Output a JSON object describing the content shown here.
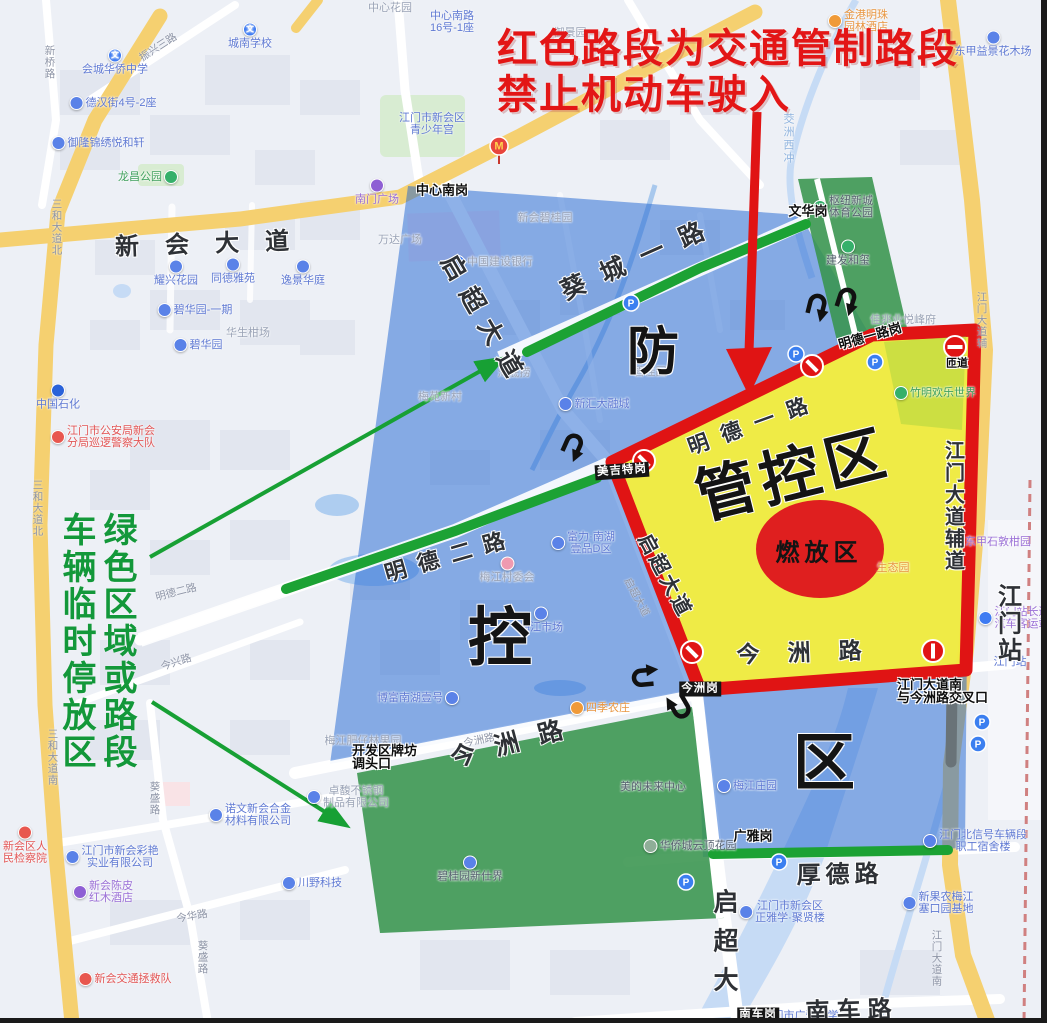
{
  "annotations": {
    "red_notice_line1": "红色路段为交通管制路段",
    "red_notice_line2": "禁止机动车驶入",
    "green_note_phrase1": "绿色区域或路段",
    "green_note_phrase2": "车辆临时停放区"
  },
  "zones": {
    "blue_zone_name": "防控区",
    "blue_zone_chars": [
      {
        "c": "防",
        "x": 653,
        "y": 347,
        "size": 52
      },
      {
        "c": "控",
        "x": 500,
        "y": 633,
        "size": 64
      },
      {
        "c": "区",
        "x": 824,
        "y": 757,
        "size": 62
      }
    ],
    "yellow_zone_label": {
      "t": "管控区",
      "x": 792,
      "y": 470,
      "size": 60,
      "sp": 6,
      "rot": -14
    },
    "firework_label": {
      "t": "燃放区",
      "x": 819,
      "y": 550,
      "size": 24,
      "sp": 5
    }
  },
  "road_names_big": [
    {
      "t": "新会大道",
      "x": 215,
      "y": 241,
      "size": 24,
      "sp": 26,
      "rot": -2
    },
    {
      "t": "启超大道",
      "x": 486,
      "y": 320,
      "size": 25,
      "sp": 12,
      "rot": 60
    },
    {
      "t": "葵城一路",
      "x": 640,
      "y": 256,
      "size": 25,
      "sp": 18,
      "rot": -24
    },
    {
      "t": "明德一路",
      "x": 754,
      "y": 423,
      "size": 21,
      "sp": 14,
      "rot": -20
    },
    {
      "t": "明德二路",
      "x": 450,
      "y": 554,
      "size": 22,
      "sp": 12,
      "rot": -16
    },
    {
      "t": "今洲路",
      "x": 516,
      "y": 740,
      "size": 25,
      "sp": 20,
      "rot": -15
    },
    {
      "t": "今洲路",
      "x": 813,
      "y": 650,
      "size": 23,
      "sp": 28,
      "rot": -2
    },
    {
      "t": "启超大道",
      "x": 667,
      "y": 575,
      "size": 20,
      "sp": 3,
      "rot": 62
    },
    {
      "t": "厚德路",
      "x": 840,
      "y": 872,
      "size": 24,
      "sp": 5,
      "rot": -1
    },
    {
      "t": "南车路",
      "x": 852,
      "y": 1008,
      "size": 24,
      "sp": 7,
      "rot": -2
    },
    {
      "t": "启超大",
      "x": 723,
      "y": 947,
      "size": 25,
      "sp": 14,
      "vert": true
    },
    {
      "t": "江门大道辅道",
      "x": 953,
      "y": 506,
      "size": 20,
      "sp": 2,
      "vert": true
    },
    {
      "t": "江门站",
      "x": 1007,
      "y": 624,
      "size": 24,
      "sp": 3,
      "vert": true
    }
  ],
  "checkpoints": [
    {
      "t": [
        "中心南岗"
      ],
      "x": 442,
      "y": 190
    },
    {
      "t": [
        "文华岗"
      ],
      "x": 808,
      "y": 211
    },
    {
      "t": [
        "明德一路岗"
      ],
      "x": 870,
      "y": 336,
      "rot": -16
    },
    {
      "t": [
        "美吉特岗"
      ],
      "x": 622,
      "y": 471,
      "s": "inv",
      "rot": -4
    },
    {
      "t": [
        "今洲岗"
      ],
      "x": 700,
      "y": 689,
      "s": "inv"
    },
    {
      "t": [
        "南车岗"
      ],
      "x": 758,
      "y": 1015,
      "s": "inv"
    },
    {
      "t": [
        "开发区牌坊",
        "调头口"
      ],
      "x": 352,
      "y": 744,
      "anchor": "l"
    },
    {
      "t": [
        "广雅岗"
      ],
      "x": 753,
      "y": 836
    },
    {
      "t": [
        "江门大道南",
        "与今洲路交叉口"
      ],
      "x": 897,
      "y": 678,
      "anchor": "l"
    },
    {
      "t": [
        "匝道"
      ],
      "x": 957,
      "y": 364,
      "size": 11
    }
  ],
  "pois": [
    {
      "t": [
        "会城华侨中学"
      ],
      "x": 115,
      "y": 62,
      "s": "b",
      "ic": "#3e7bf2",
      "g": "文",
      "ip": "t"
    },
    {
      "t": [
        "城南学校"
      ],
      "x": 250,
      "y": 36,
      "s": "b",
      "ic": "#3e7bf2",
      "g": "文",
      "ip": "t"
    },
    {
      "t": [
        "德汉街4号-2座"
      ],
      "x": 113,
      "y": 103,
      "s": "b",
      "ic": "#5a82e8",
      "ip": "l"
    },
    {
      "t": [
        "御隆锦绣悦和轩"
      ],
      "x": 98,
      "y": 143,
      "s": "b",
      "ic": "#5a82e8",
      "ip": "l"
    },
    {
      "t": [
        "龙昌公园"
      ],
      "x": 148,
      "y": 177,
      "s": "g",
      "ic": "#35b06a",
      "ip": "r"
    },
    {
      "t": [
        "中心花园"
      ],
      "x": 390,
      "y": 8,
      "s": "f"
    },
    {
      "t": [
        "中心南路",
        "16号-1座"
      ],
      "x": 452,
      "y": 22,
      "s": "b"
    },
    {
      "t": [
        "江门市新会区",
        "青少年宫"
      ],
      "x": 432,
      "y": 124,
      "s": "b"
    },
    {
      "t": [
        "南门广场"
      ],
      "x": 377,
      "y": 192,
      "s": "p",
      "ic": "#8e5fd4",
      "ip": "t"
    },
    {
      "t": [
        "万达广场"
      ],
      "x": 400,
      "y": 240,
      "s": "f"
    },
    {
      "t": [
        "御景园"
      ],
      "x": 570,
      "y": 33,
      "s": "f"
    },
    {
      "t": [
        "金港明珠",
        "园林酒店"
      ],
      "x": 858,
      "y": 21,
      "s": "o",
      "ic": "#f09a38",
      "ip": "l"
    },
    {
      "t": [
        "东甲益景花木场"
      ],
      "x": 993,
      "y": 44,
      "s": "b",
      "ic": "#5a82e8",
      "ip": "t"
    },
    {
      "t": [
        "碧桂园"
      ],
      "x": 650,
      "y": 372,
      "s": "f"
    },
    {
      "t": [
        "新会碧桂园"
      ],
      "x": 545,
      "y": 218,
      "s": "f"
    },
    {
      "t": [
        "中国建设银行"
      ],
      "x": 492,
      "y": 262,
      "s": "f",
      "ic": "#3e7bf2",
      "ip": "l"
    },
    {
      "t": [
        "耀兴花园"
      ],
      "x": 176,
      "y": 273,
      "s": "b",
      "ic": "#5a82e8",
      "ip": "t"
    },
    {
      "t": [
        "同德雅苑"
      ],
      "x": 233,
      "y": 271,
      "s": "b",
      "ic": "#5a82e8",
      "ip": "t"
    },
    {
      "t": [
        "逸景华庭"
      ],
      "x": 303,
      "y": 273,
      "s": "b",
      "ic": "#5a82e8",
      "ip": "t"
    },
    {
      "t": [
        "碧华园-一期"
      ],
      "x": 195,
      "y": 310,
      "s": "b",
      "ic": "#5a82e8",
      "ip": "l"
    },
    {
      "t": [
        "碧华园"
      ],
      "x": 198,
      "y": 345,
      "s": "b",
      "ic": "#5a82e8",
      "ip": "l"
    },
    {
      "t": [
        "华生柑场"
      ],
      "x": 248,
      "y": 333,
      "s": "f"
    },
    {
      "t": [
        "中国石化"
      ],
      "x": 58,
      "y": 397,
      "s": "b",
      "ic": "#2a62d9",
      "ip": "t"
    },
    {
      "t": [
        "江门市公安局新会",
        "分局巡逻警察大队"
      ],
      "x": 103,
      "y": 437,
      "s": "r",
      "ic": "#e8574f",
      "ip": "l"
    },
    {
      "t": [
        "海底捞"
      ],
      "x": 514,
      "y": 373,
      "s": "f"
    },
    {
      "t": [
        "新汇大融城"
      ],
      "x": 594,
      "y": 404,
      "s": "b",
      "ic": "#5a82e8",
      "ip": "l"
    },
    {
      "t": [
        "梅苑新村"
      ],
      "x": 440,
      "y": 397,
      "s": "f"
    },
    {
      "t": [
        "富力·南湖",
        "壹品D区"
      ],
      "x": 583,
      "y": 543,
      "s": "b",
      "ic": "#5a82e8",
      "ip": "l"
    },
    {
      "t": [
        "梅江村委会"
      ],
      "x": 507,
      "y": 570,
      "s": "f",
      "ic": "#ef9ab0",
      "ip": "t"
    },
    {
      "t": [
        "梅江市场"
      ],
      "x": 541,
      "y": 620,
      "s": "b",
      "ic": "#5a82e8",
      "ip": "t"
    },
    {
      "t": [
        "博富南湖壹号"
      ],
      "x": 418,
      "y": 698,
      "s": "b",
      "ic": "#5a82e8",
      "ip": "r"
    },
    {
      "t": [
        "梅江肥仔林果园"
      ],
      "x": 363,
      "y": 741,
      "s": "f"
    },
    {
      "t": [
        "卓馥不锈钢",
        "制品有限公司"
      ],
      "x": 348,
      "y": 797,
      "s": "f",
      "ic": "#5a82e8",
      "ip": "l"
    },
    {
      "t": [
        "碧桂园新仕界"
      ],
      "x": 470,
      "y": 869,
      "s": "d",
      "ic": "#5a82e8",
      "ip": "t"
    },
    {
      "t": [
        "四季农庄"
      ],
      "x": 600,
      "y": 708,
      "s": "o",
      "ic": "#f09a38",
      "ip": "l"
    },
    {
      "t": [
        "美的未来中心"
      ],
      "x": 653,
      "y": 787,
      "s": "d"
    },
    {
      "t": [
        "华侨城云顶花园"
      ],
      "x": 690,
      "y": 846,
      "s": "d",
      "ic": "#8fae98",
      "ip": "l"
    },
    {
      "t": [
        "梅江庄园"
      ],
      "x": 747,
      "y": 786,
      "s": "b",
      "ic": "#5a82e8",
      "ip": "l"
    },
    {
      "t": [
        "诺文新会合金",
        "材料有限公司"
      ],
      "x": 250,
      "y": 815,
      "s": "b",
      "ic": "#5a82e8",
      "ip": "l"
    },
    {
      "t": [
        "江门市新会彩艳",
        "实业有限公司"
      ],
      "x": 112,
      "y": 857,
      "s": "b",
      "ic": "#5a82e8",
      "ip": "l"
    },
    {
      "t": [
        "新会陈皮",
        "红木酒店"
      ],
      "x": 103,
      "y": 892,
      "s": "p",
      "ic": "#8e5fd4",
      "ip": "l"
    },
    {
      "t": [
        "新会区人",
        "民检察院"
      ],
      "x": 25,
      "y": 845,
      "s": "r",
      "ic": "#e8574f",
      "ip": "t"
    },
    {
      "t": [
        "新会交通拯救队"
      ],
      "x": 125,
      "y": 979,
      "s": "r",
      "ic": "#e8574f",
      "ip": "l"
    },
    {
      "t": [
        "川野科技"
      ],
      "x": 312,
      "y": 883,
      "s": "b",
      "ic": "#5a82e8",
      "ip": "l"
    },
    {
      "t": [
        "佳兆业悦峰府"
      ],
      "x": 903,
      "y": 320,
      "s": "f"
    },
    {
      "t": [
        "竹明欢乐世界"
      ],
      "x": 935,
      "y": 393,
      "s": "g",
      "ic": "#35b06a",
      "ip": "l"
    },
    {
      "t": [
        "建发和玺"
      ],
      "x": 848,
      "y": 253,
      "s": "d",
      "ic": "#35b06a",
      "ip": "t"
    },
    {
      "t": [
        "枢纽新城",
        "体育公园"
      ],
      "x": 843,
      "y": 207,
      "s": "d",
      "ic": "#35b06a",
      "ip": "l"
    },
    {
      "t": [
        "东甲石敦柑园"
      ],
      "x": 998,
      "y": 542,
      "s": "p"
    },
    {
      "t": [
        "生态园"
      ],
      "x": 893,
      "y": 568,
      "s": "o"
    },
    {
      "t": [
        "江门站长途",
        "汽车客运站"
      ],
      "x": 1014,
      "y": 618,
      "s": "p",
      "ic": "#3e7bf2",
      "ip": "l"
    },
    {
      "t": [
        "江门站"
      ],
      "x": 1010,
      "y": 662,
      "s": "b"
    },
    {
      "t": [
        "江门北信号车辆段",
        "职工宿舍楼"
      ],
      "x": 975,
      "y": 841,
      "s": "b",
      "ic": "#5a82e8",
      "ip": "l"
    },
    {
      "t": [
        "新果农梅江",
        "塞口园基地"
      ],
      "x": 938,
      "y": 903,
      "s": "b",
      "ic": "#5a82e8",
      "ip": "l"
    },
    {
      "t": [
        "江门市新会区",
        "正雅学·聚贤楼"
      ],
      "x": 782,
      "y": 912,
      "s": "b",
      "ic": "#5a82e8",
      "ip": "l"
    },
    {
      "t": [
        "江门市广雅中学"
      ],
      "x": 800,
      "y": 1016,
      "s": "b"
    },
    {
      "t": [
        "茭洲西冲"
      ],
      "x": 788,
      "y": 139,
      "s": "w",
      "vert": true
    }
  ],
  "road_labels": [
    {
      "t": "新桥路",
      "x": 50,
      "y": 62,
      "vert": true
    },
    {
      "t": "振兴三路",
      "x": 158,
      "y": 47,
      "rot": -33
    },
    {
      "t": "三和大道北",
      "x": 57,
      "y": 227,
      "vert": true
    },
    {
      "t": "三和大道北",
      "x": 38,
      "y": 508,
      "vert": true
    },
    {
      "t": "三和大道南",
      "x": 53,
      "y": 757,
      "vert": true
    },
    {
      "t": "江门大道辅",
      "x": 982,
      "y": 320,
      "vert": true
    },
    {
      "t": "江门大道南",
      "x": 937,
      "y": 958,
      "vert": true
    },
    {
      "t": "今华路",
      "x": 192,
      "y": 916,
      "rot": -10
    },
    {
      "t": "葵盛路",
      "x": 155,
      "y": 798,
      "vert": true
    },
    {
      "t": "葵盛路",
      "x": 203,
      "y": 957,
      "vert": true
    },
    {
      "t": "明德二路",
      "x": 176,
      "y": 592,
      "rot": -14
    },
    {
      "t": "今兴路",
      "x": 176,
      "y": 662,
      "rot": -18
    },
    {
      "t": "今洲路",
      "x": 479,
      "y": 740,
      "rot": -12
    },
    {
      "t": "启超大道",
      "x": 637,
      "y": 597,
      "rot": 62
    }
  ],
  "map_icons": {
    "parking_glyph": "P",
    "parking": [
      [
        796,
        354
      ],
      [
        875,
        362
      ],
      [
        631,
        303
      ],
      [
        686,
        882
      ],
      [
        779,
        862
      ],
      [
        982,
        722
      ],
      [
        978,
        744
      ]
    ],
    "no_entry": [
      {
        "x": 644,
        "y": 461,
        "a": 45
      },
      {
        "x": 692,
        "y": 652,
        "a": 45
      },
      {
        "x": 812,
        "y": 366,
        "a": 45
      },
      {
        "x": 955,
        "y": 347,
        "a": 0
      },
      {
        "x": 933,
        "y": 651,
        "a": 90
      }
    ],
    "uturn": [
      {
        "x": 818,
        "y": 300,
        "a": 14
      },
      {
        "x": 848,
        "y": 294,
        "a": 18
      },
      {
        "x": 575,
        "y": 440,
        "a": 24
      },
      {
        "x": 638,
        "y": 678,
        "a": -95
      },
      {
        "x": 683,
        "y": 712,
        "a": 150
      }
    ],
    "mcdonalds": {
      "x": 499,
      "y": 146,
      "glyph": "M"
    }
  },
  "colors": {
    "zone_blue": "rgba(30,100,210,0.5)",
    "zone_green": "rgba(56,148,77,0.88)",
    "zone_yellow": "rgba(248,240,58,0.93)",
    "restricted_red": "#e01414",
    "green_road": "#1ca234",
    "annotation_red": "#e31616",
    "annotation_green": "#13983a",
    "firework_ellipse": "#df1f1f"
  }
}
